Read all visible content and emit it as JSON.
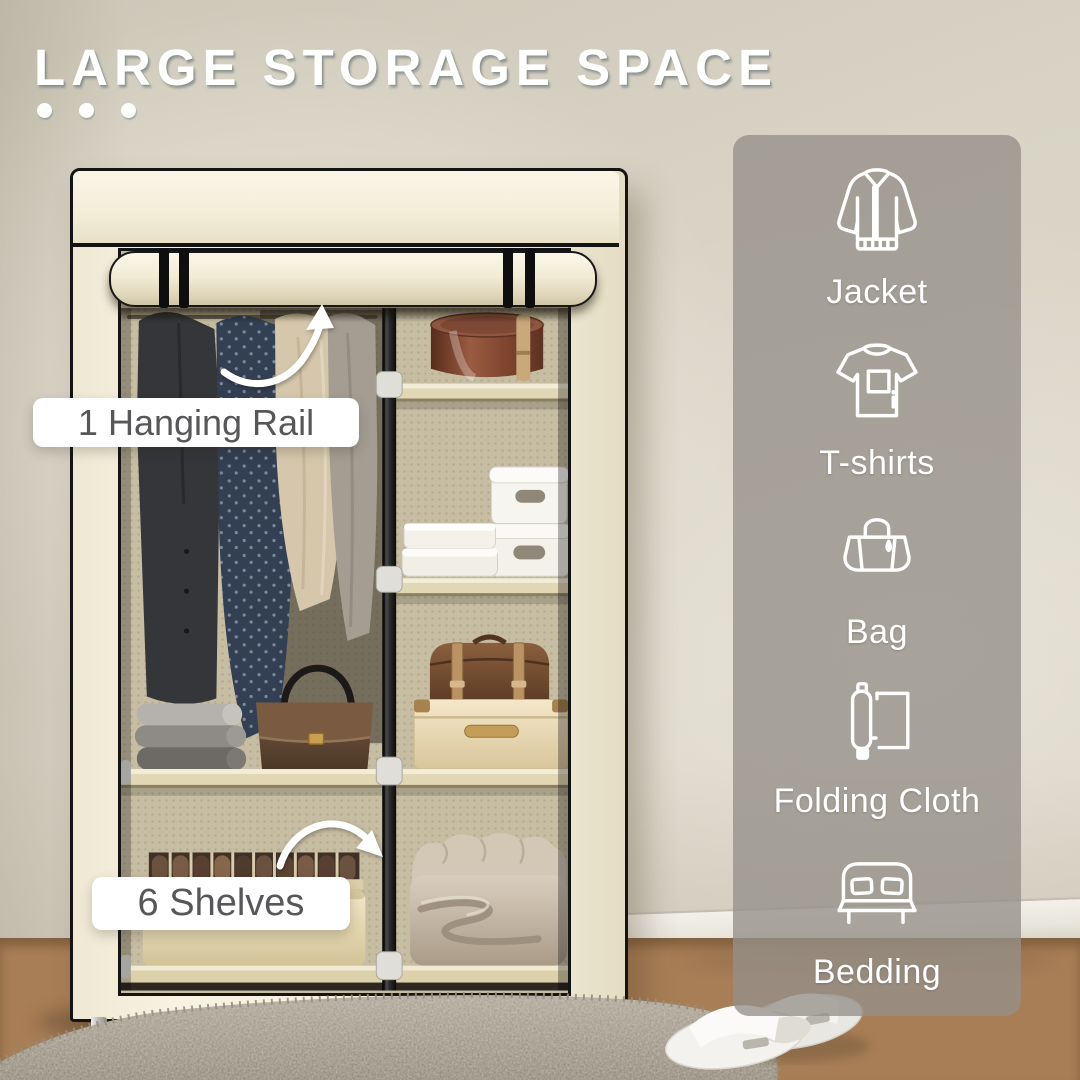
{
  "header": {
    "title": "LARGE STORAGE SPACE"
  },
  "callouts": [
    {
      "id": "hanging-rail",
      "label": "1 Hanging Rail"
    },
    {
      "id": "shelves",
      "label": "6 Shelves"
    }
  ],
  "sidebar": {
    "items": [
      {
        "icon": "jacket-icon",
        "label": "Jacket"
      },
      {
        "icon": "tshirt-icon",
        "label": "T-shirts"
      },
      {
        "icon": "bag-icon",
        "label": "Bag"
      },
      {
        "icon": "folding-cloth-icon",
        "label": "Folding Cloth"
      },
      {
        "icon": "bedding-icon",
        "label": "Bedding"
      }
    ]
  },
  "colors": {
    "title_text": "#ffffff",
    "wall": "#d8d3c5",
    "wardrobe_fabric": "#f4eedd",
    "panel_overlay": "rgba(149,144,137,0.78)",
    "callout_text": "#57575a",
    "arrow": "#ffffff",
    "floor_wood": "#b78a5f"
  }
}
